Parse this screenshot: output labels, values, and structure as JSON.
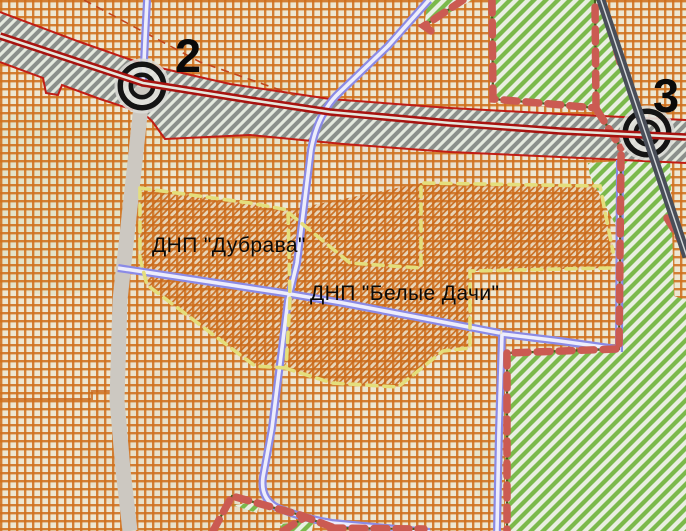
{
  "map": {
    "labels": [
      {
        "text": "ДНП \"Дубрава\"",
        "x": 152,
        "y": 252
      },
      {
        "text": "ДНП \"Белые Дачи\"",
        "x": 310,
        "y": 300
      }
    ],
    "markers": [
      {
        "label": "2",
        "cx": 142,
        "cy": 86,
        "label_x": 175,
        "label_y": 72
      },
      {
        "label": "3",
        "cx": 647,
        "cy": 133,
        "label_x": 653,
        "label_y": 112
      }
    ],
    "zones": [
      {
        "name": "ДНП \"Дубрава\"",
        "fill": "orange-diagonal-hatch",
        "boundary": "yellow-dashed"
      },
      {
        "name": "ДНП \"Белые Дачи\"",
        "fill": "orange-diagonal-hatch",
        "boundary": "yellow-dashed"
      },
      {
        "name": "forest-zone",
        "fill": "green-diagonal-stripes",
        "boundary": "red-dashed"
      }
    ],
    "colors": {
      "base": "#EDE7D2",
      "grid_orange": "#CF701E",
      "hatch_orange": "#C8681A",
      "green_zone": "#7BB94B",
      "green_stripe": "#E9EFE2",
      "highway_fill": "#E5E9DE",
      "highway_stripe": "#8B8F8B",
      "highway_casing": "#C11D15",
      "highway_centerline": "#A81310",
      "dark_road": "#494E59",
      "blue_road": "#8A8AE6",
      "blue_road_center": "#EDEDFB",
      "gray_road": "#CCC8C1",
      "zone_boundary_yellow": "#E4DE7C",
      "boundary_red_dash": "#CB5B52",
      "boundary_green_line": "#45621F",
      "marker_ring": "#141414",
      "label_text": "#0A0A0A"
    }
  }
}
